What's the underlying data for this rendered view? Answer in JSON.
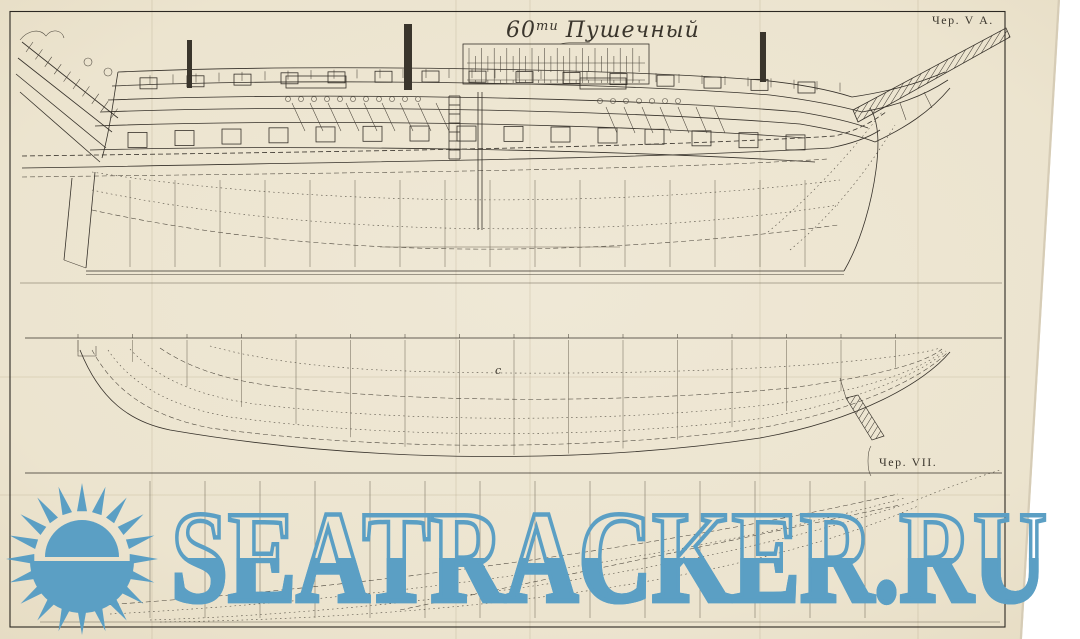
{
  "palette": {
    "background": "#ffffff",
    "paper": "#ece4cf",
    "ink": "#36312a",
    "watermark_blue": "#5b9fc4"
  },
  "plate": {
    "title": {
      "prefix": "60",
      "sup": "ти",
      "main": "Пушечный"
    },
    "sheet_label_top_right": "Чер. V А.",
    "sheet_label_lower": "Чер. VII.",
    "station_letter": "c"
  },
  "watermark": {
    "text": "SEATRACKER.RU",
    "logo": "sunburst"
  }
}
